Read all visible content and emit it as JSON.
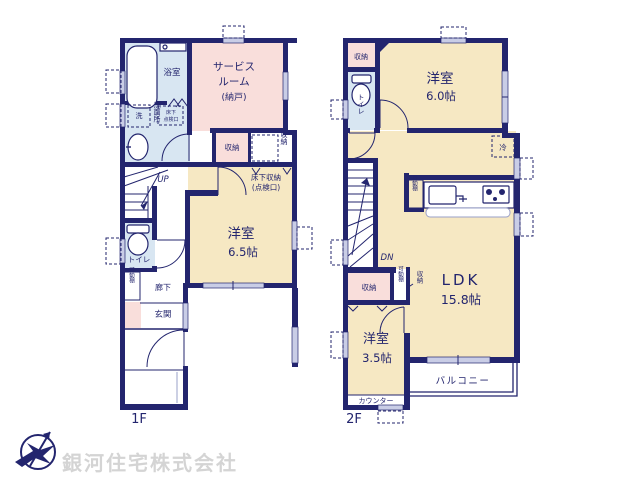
{
  "colors": {
    "wall": "#23256E",
    "room_cream": "#F6E8C3",
    "room_pink": "#F9DEDB",
    "room_blue": "#D8E6F2",
    "window": "#C9CDE6",
    "logo_text": "#D4D4D4"
  },
  "floor1": {
    "label": "1F",
    "bathroom": "浴室",
    "washroom": "洗面所",
    "laundry": "洗",
    "hatch_l1": "床下",
    "hatch_l2": "点検口",
    "service_l1": "サービス",
    "service_l2": "ルーム",
    "service_l3": "(納戸)",
    "storage_a": "収納",
    "storage_b": "収納",
    "underfloor_l1": "床下収納",
    "underfloor_l2": "(点検口)",
    "western_room": "洋室",
    "western_size": "6.5帖",
    "up": "UP",
    "toilet": "トイレ",
    "shelf": "可動棚",
    "hallway": "廊下",
    "entrance": "玄関"
  },
  "floor2": {
    "label": "2F",
    "storage_top": "収納",
    "toilet": "トイレ",
    "western_a": "洋室",
    "western_a_size": "6.0帖",
    "fridge": "冷",
    "kitchen_shelf": "可動棚",
    "down": "DN",
    "storage_left": "収納",
    "shelf": "可動棚",
    "storage_small": "収納",
    "ldk": "LDK",
    "ldk_size": "15.8帖",
    "western_b": "洋室",
    "western_b_size": "3.5帖",
    "counter": "カウンター",
    "balcony": "バルコニー"
  },
  "footer": {
    "company": "銀河住宅株式会社"
  }
}
